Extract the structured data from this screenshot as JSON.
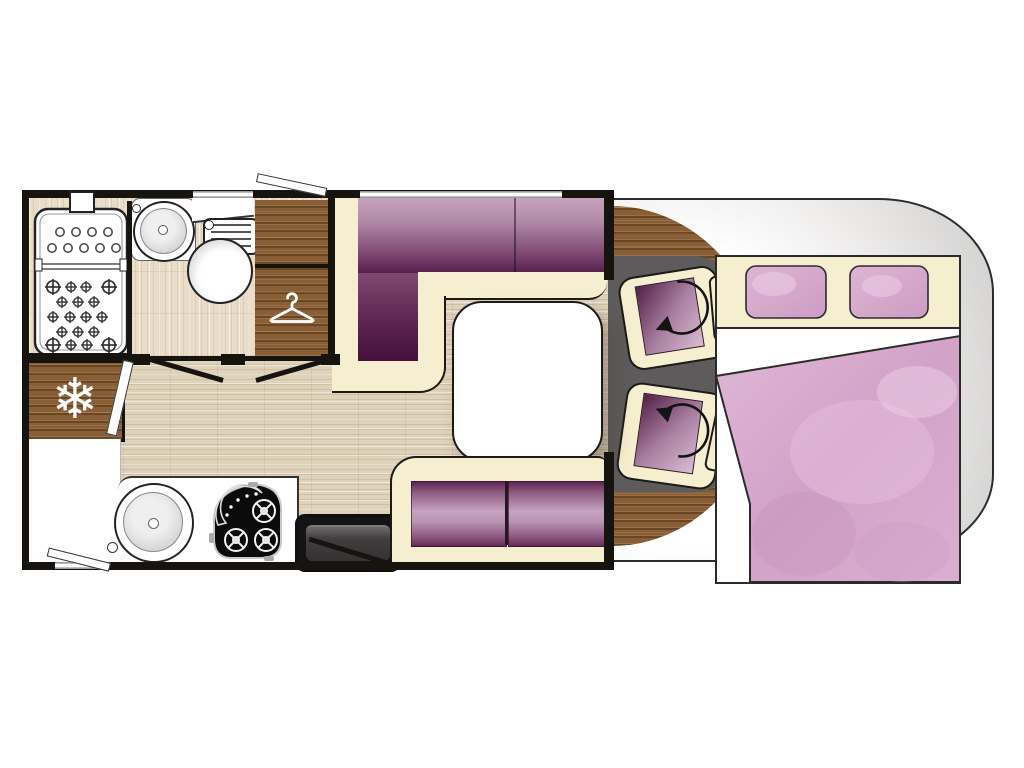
{
  "scene": {
    "label": "Motorhome floor plan (top view)"
  },
  "colors": {
    "wall": "#17130f",
    "cream": "#f6efcf",
    "wood": "#8a5e34",
    "floor": "#dfd2bb",
    "bath_floor": "#e9dcc9",
    "gray_floor": "#5d5b5c",
    "purple_light": "#c9a6c2",
    "purple_dark": "#4a123f",
    "pink": "#d6a9cd",
    "cab_gray": "#c6c5c4",
    "white": "#ffffff"
  },
  "icons": {
    "snowflake": {
      "name": "snowflake-icon",
      "glyph": "❄"
    },
    "hanger": {
      "name": "hanger-icon"
    },
    "swivel_arrow": {
      "name": "swivel-arrow-icon",
      "count": 2
    }
  },
  "fixtures": {
    "bathroom": [
      "shower tray",
      "washbasin",
      "toilet"
    ],
    "storage": [
      "overhead cabinet",
      "wardrobe",
      "refrigerator"
    ],
    "kitchen": [
      "round sink",
      "hob",
      "entry step"
    ],
    "lounge": [
      "L-shaped dinette sofa",
      "side bench",
      "table"
    ],
    "cab": [
      "swivel seat front",
      "swivel seat rear"
    ],
    "bedroom": [
      "double bed",
      "pillow",
      "pillow",
      "duvet"
    ]
  }
}
